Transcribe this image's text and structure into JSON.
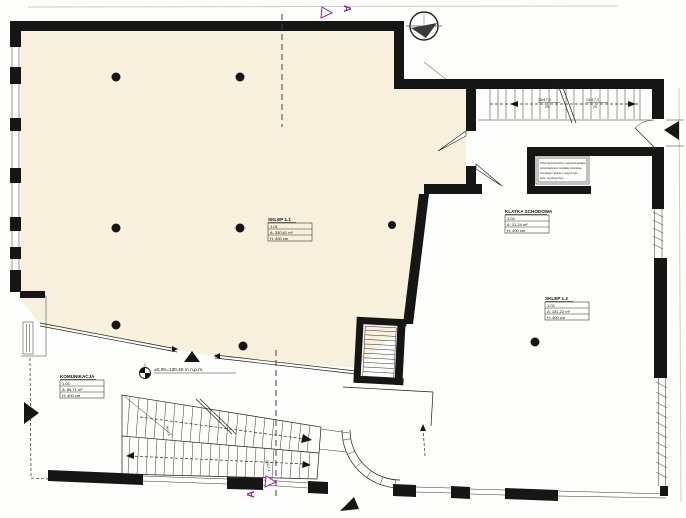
{
  "drawing_type": "architectural floor plan (ground floor, scanned)",
  "rooms": [
    {
      "id": "sklep-1-1",
      "name": "SKLEP 1.1",
      "number": "1.01",
      "area": "A: 330,61 m²",
      "height": "H: 400 cm"
    },
    {
      "id": "sklep-1-2",
      "name": "SKLEP 1.2",
      "number": "1.02",
      "area": "A: 181,22 m²",
      "height": "H: 400 cm"
    },
    {
      "id": "komunikacja",
      "name": "KOMUNIKACJA",
      "number": "1.03",
      "area": "A: 66,71 m²",
      "height": "H: 400 cm"
    },
    {
      "id": "klatka-schodowa",
      "name": "KLATKA SCHODOWA",
      "number": "1.04",
      "area": "A: 31,24 m²",
      "height": "H: 400 cm"
    }
  ],
  "annotations": {
    "elevation": "±0,00=130,40 m n.p.m.",
    "section_letter": "A",
    "stairwell_run_label": "13x17,3",
    "stairwell_risers": "29",
    "stair_lower_label_1": "9x17,4",
    "stair_lower_label_2": "19x17,4",
    "note_lines": [
      "Drzwi dymoszczelne i samozamykające",
      "przed wejściem na klatkę schodową",
      "zamykane zgodnie z wytycznymi",
      "ppoż. wg ekspertyzy"
    ]
  },
  "symbols": [
    "north-indicator",
    "level-marker",
    "entrance-arrows",
    "section-line-A-A"
  ],
  "colors": {
    "room_fill_cream": "#f6f0dd",
    "wall_black": "#161616",
    "section_marker_purple": "#8e2390",
    "paper": "#fdfdfc"
  }
}
